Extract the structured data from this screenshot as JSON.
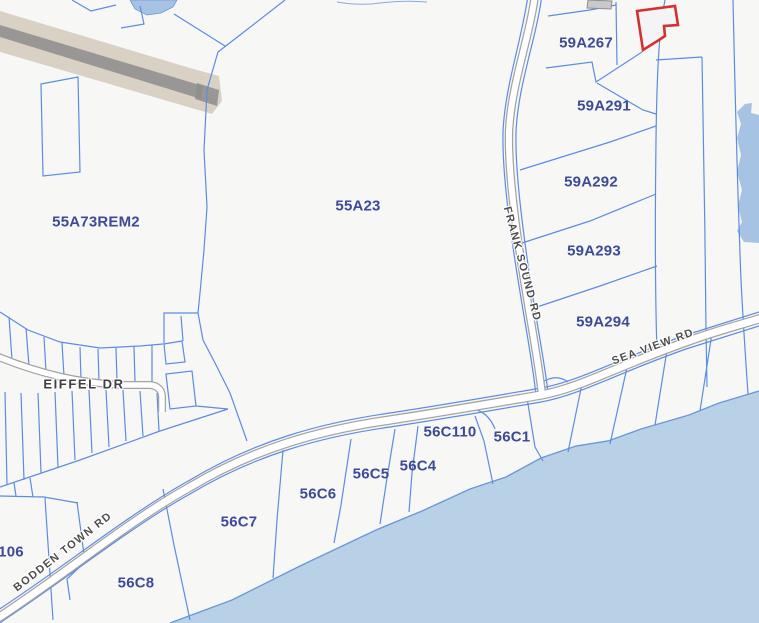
{
  "map": {
    "title": "Cadastral parcel map",
    "colors": {
      "background": "#f7f7f6",
      "sea": "#b9d1e7",
      "shoreline": "#6b98d8",
      "pond": "#a6c3e3",
      "parcel_line": "#5d8ce2",
      "parcel_label": "#3c4b94",
      "road_fill": "#ffffff",
      "road_casing": "#a3a3a3",
      "road_label": "#4d4d4d",
      "selected_parcel_outline": "#d4302f",
      "runway": "#d9d2c4",
      "runway_stripe": "#8d8d8d",
      "building": "#c9c9c9"
    },
    "selected_parcel": {
      "status": "highlighted-red-outline"
    },
    "parcel_labels": [
      {
        "id": "55A73REM2",
        "x": 96,
        "y": 222
      },
      {
        "id": "55A23",
        "x": 358,
        "y": 206
      },
      {
        "id": "59A267",
        "x": 586,
        "y": 43
      },
      {
        "id": "59A291",
        "x": 604,
        "y": 106
      },
      {
        "id": "59A292",
        "x": 591,
        "y": 182
      },
      {
        "id": "59A293",
        "x": 594,
        "y": 251
      },
      {
        "id": "59A294",
        "x": 603,
        "y": 322
      },
      {
        "id": "56C110",
        "x": 450,
        "y": 432
      },
      {
        "id": "56C1",
        "x": 512,
        "y": 437
      },
      {
        "id": "56C4",
        "x": 418,
        "y": 466
      },
      {
        "id": "56C5",
        "x": 371,
        "y": 474
      },
      {
        "id": "56C6",
        "x": 318,
        "y": 494
      },
      {
        "id": "56C7",
        "x": 239,
        "y": 522
      },
      {
        "id": "56C8",
        "x": 136,
        "y": 583
      },
      {
        "id": "106",
        "x": 11,
        "y": 552
      }
    ],
    "road_labels": [
      {
        "name": "FRANK SOUND RD",
        "x": 522,
        "y": 264,
        "angle": 75
      },
      {
        "name": "SEA VIEW RD",
        "x": 653,
        "y": 347,
        "angle": -20
      },
      {
        "name": "BODDEN TOWN RD",
        "x": 63,
        "y": 552,
        "angle": -38
      },
      {
        "name": "EIFFEL DR",
        "x": 84,
        "y": 384,
        "angle": 0
      }
    ]
  }
}
